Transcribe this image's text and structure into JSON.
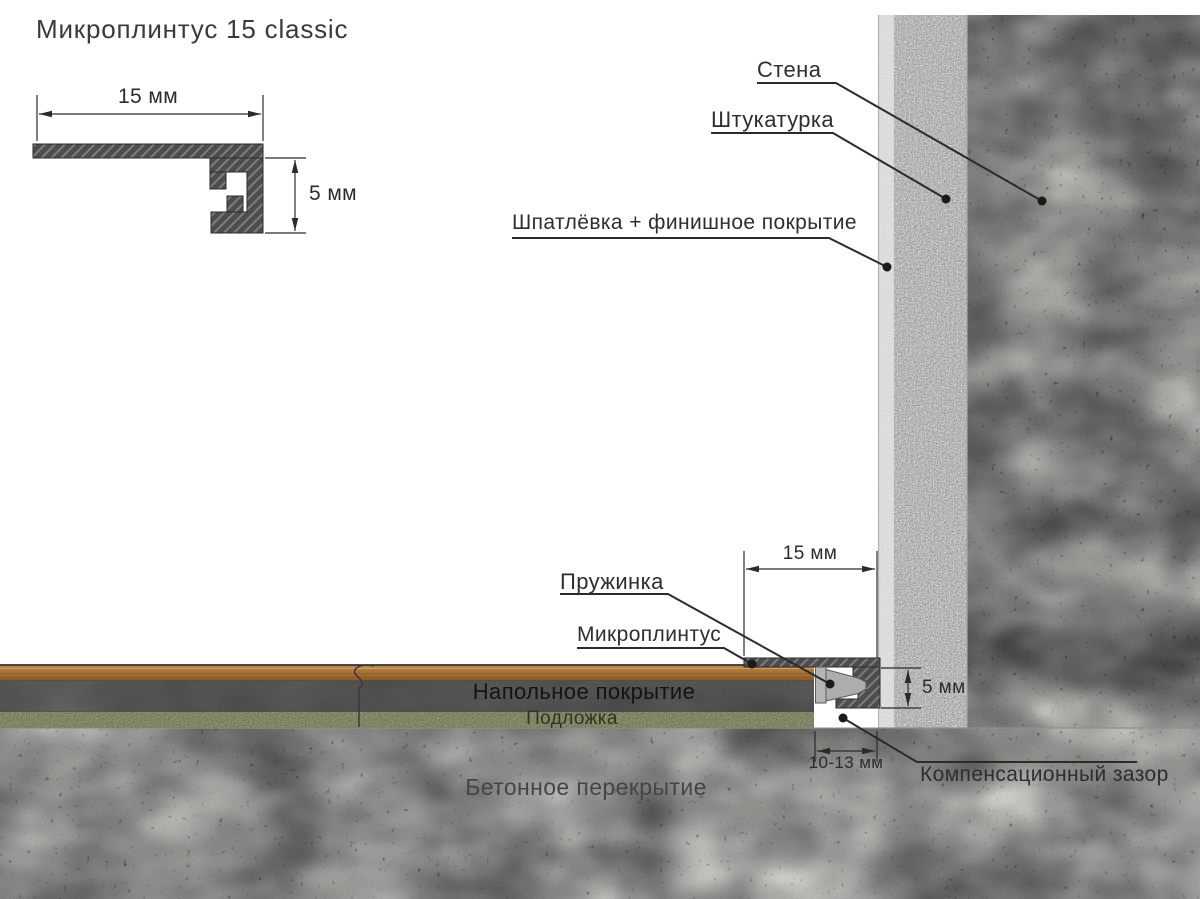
{
  "title": "Микроплинтус 15 classic",
  "profile_drawing": {
    "width_dim": "15 мм",
    "height_dim": "5 мм"
  },
  "wall": {
    "wall_label": "Стена",
    "plaster_label": "Штукатурка",
    "finish_label": "Шпатлёвка + финишное покрытие"
  },
  "junction": {
    "spring_label": "Пружинка",
    "skirting_label": "Микроплинтус",
    "gap_label": "Компенсационный зазор",
    "width_dim": "15 мм",
    "height_dim": "5 мм",
    "gap_dim": "10-13 мм"
  },
  "floor": {
    "covering_label": "Напольное покрытие",
    "underlay_label": "Подложка",
    "slab_label": "Бетонное перекрытие"
  },
  "colors": {
    "line": "#2b2b2b",
    "profile_fill": "#4d4d4d",
    "hatch_light": "#7d7d7d",
    "spring_fill": "#b5b5b5",
    "wood_light": "#c08a4e",
    "wood_mid": "#a87338",
    "wood_dark": "#8a5a2a",
    "floor_dark_layer": "#676767",
    "underlay_green": "#a3b083",
    "finish_strip": "#ecebe8",
    "plaster": "#f4f3f0",
    "concrete_wall": "#c7c7c3",
    "concrete_slab": "#d2d2ce"
  }
}
